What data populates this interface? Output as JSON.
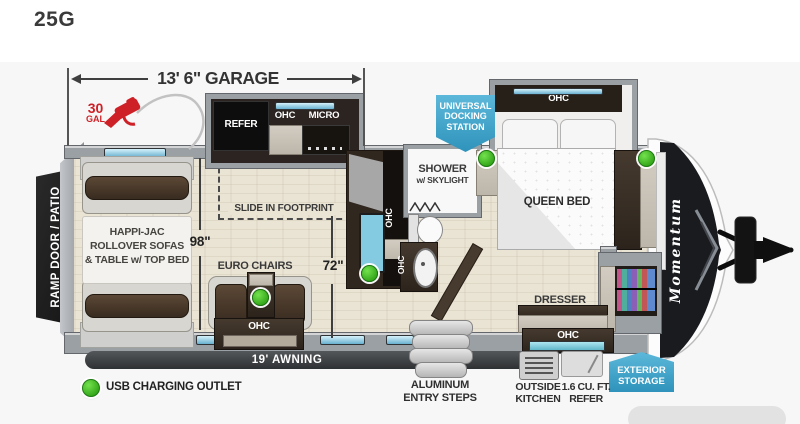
{
  "title": "25G",
  "brand": "Momentum",
  "ohc": "OHC",
  "dimensions": {
    "garage": "13' 6\" GARAGE",
    "garage_width": "98\"",
    "living_width": "72\"",
    "awning": "19' AWNING"
  },
  "fuel": {
    "amount": "30",
    "unit": "GAL"
  },
  "kitchen": {
    "refer": "REFER",
    "micro": "MICRO"
  },
  "callouts": {
    "docking": [
      "UNIVERSAL",
      "DOCKING",
      "STATION"
    ],
    "exterior_storage": [
      "EXTERIOR",
      "STORAGE"
    ]
  },
  "garage": {
    "ramp": "RAMP DOOR / PATIO",
    "sofa_label": [
      "HAPPI-JAC",
      "ROLLOVER SOFAS",
      "& TABLE w/ TOP BED"
    ],
    "euro_chairs": "EURO CHAIRS",
    "slide_footprint": "SLIDE IN FOOTPRINT"
  },
  "bathroom": {
    "shower": [
      "SHOWER",
      "w/ SKYLIGHT"
    ]
  },
  "bedroom": {
    "queen_bed": "QUEEN BED",
    "dresser": "DRESSER"
  },
  "exterior": {
    "steps": [
      "ALUMINUM",
      "ENTRY STEPS"
    ],
    "outside_kitchen": [
      "OUTSIDE",
      "KITCHEN"
    ],
    "mini_refer": [
      "1.6 CU. FT.",
      "REFER"
    ]
  },
  "legend": {
    "usb": "USB CHARGING OUTLET"
  },
  "colors": {
    "callout_blue": "#3fa3cb",
    "usb_green": "#3db31d",
    "fuel_red": "#ce2127",
    "awning_dark": "#3a3d40"
  }
}
